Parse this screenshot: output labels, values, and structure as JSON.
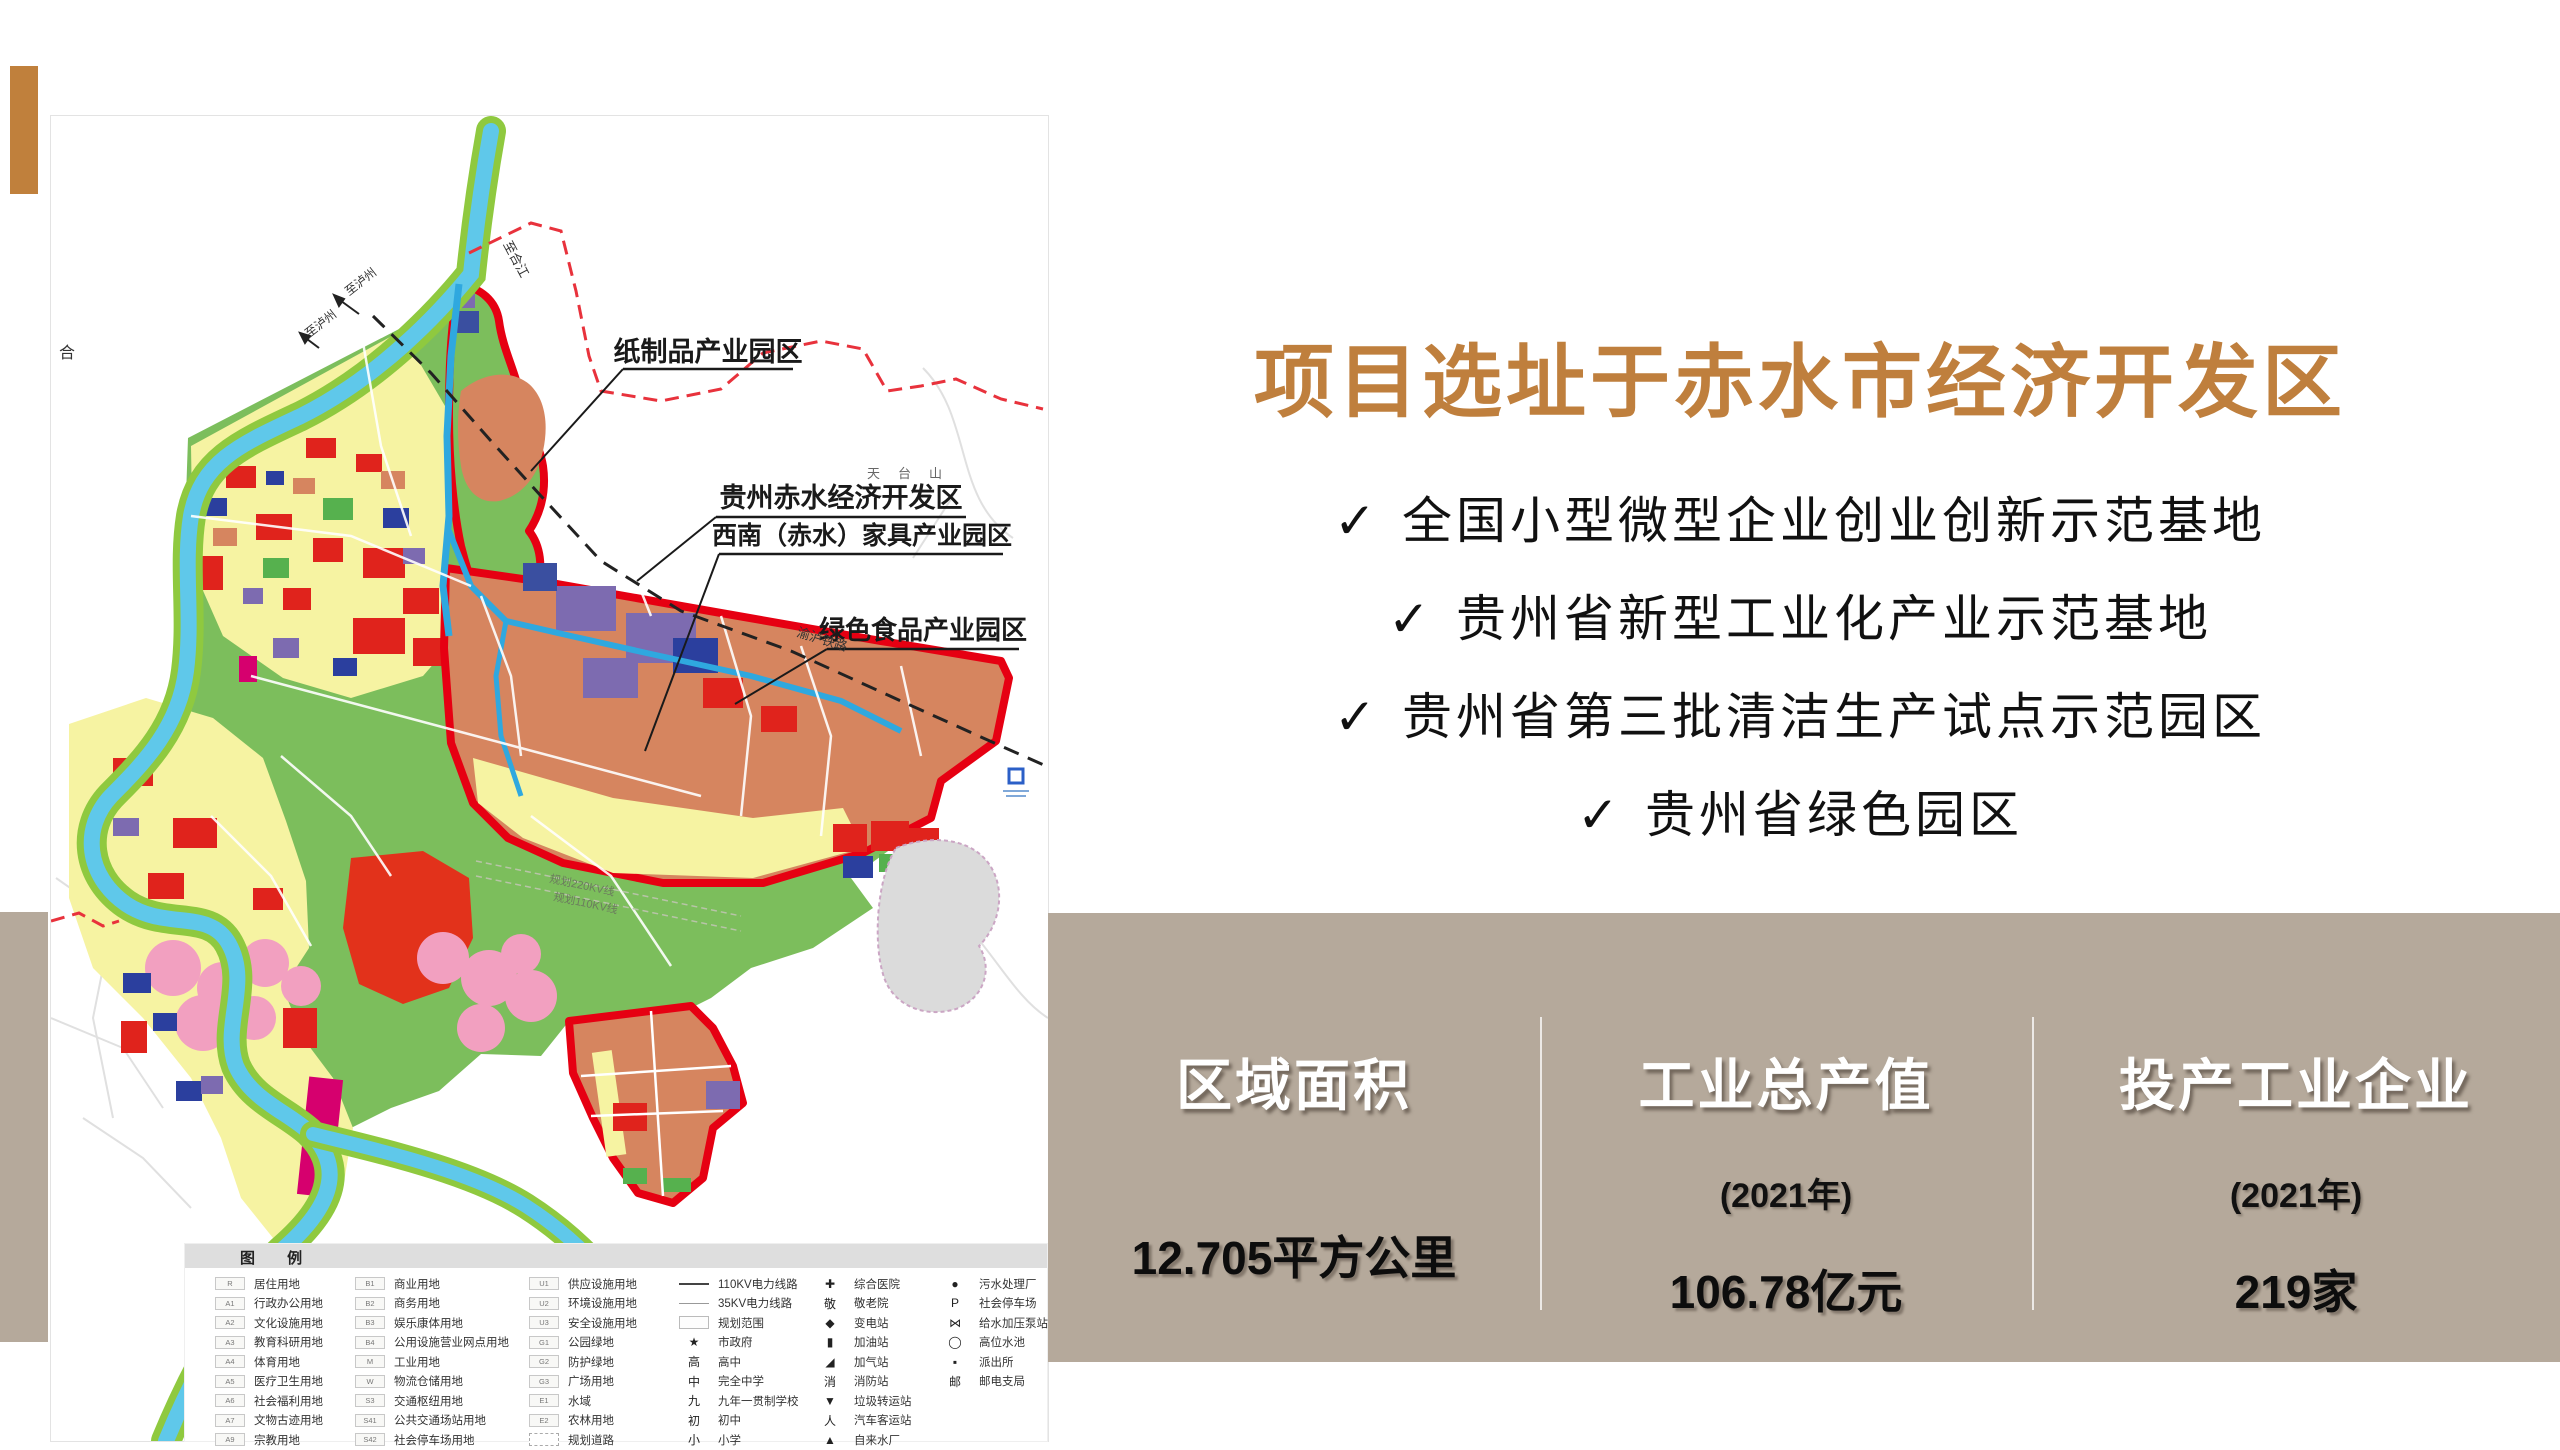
{
  "header": {
    "title": "项目建设地点"
  },
  "right_panel": {
    "headline": "项目选址于赤水市经济开发区",
    "check_glyph": "✓",
    "bullets": [
      "全国小型微型企业创业创新示范基地",
      "贵州省新型工业化产业示范基地",
      "贵州省第三批清洁生产试点示范园区",
      "贵州省绿色园区"
    ]
  },
  "stats_band": {
    "columns": [
      {
        "title": "区域面积",
        "subtitle": "",
        "value": "12.705平方公里"
      },
      {
        "title": "工业总产值",
        "subtitle": "(2021年)",
        "value": "106.78亿元"
      },
      {
        "title": "投产工业企业",
        "subtitle": "(2021年)",
        "value": "219家"
      }
    ]
  },
  "colors": {
    "accent_orange": "#C0803C",
    "headline_orange": "#BF7F3D",
    "stats_taupe": "#B5A99B",
    "map_green": "#7CBE5C",
    "map_yellow": "#F6F3A2",
    "map_salmon": "#D6855F",
    "zone_border_red": "#E60012",
    "river_blue": "#5FC8EA"
  },
  "map": {
    "labels": [
      {
        "t": "纸制品产业园区",
        "x": 657,
        "y": 245,
        "s": 27,
        "w": 700,
        "a": "middle",
        "f": "#1A1A1A"
      },
      {
        "t": "贵州赤水经济开发区",
        "x": 790,
        "y": 391,
        "s": 27,
        "w": 700,
        "a": "middle",
        "f": "#1A1A1A"
      },
      {
        "t": "西南（赤水）家具产业园区",
        "x": 811,
        "y": 428,
        "s": 25,
        "w": 700,
        "a": "middle",
        "f": "#1A1A1A"
      },
      {
        "t": "绿色食品产业园区",
        "x": 872,
        "y": 523,
        "s": 26,
        "w": 700,
        "a": "middle",
        "f": "#1A1A1A"
      },
      {
        "t": "渝泸铁路",
        "x": 745,
        "y": 520,
        "s": 13,
        "r": 17,
        "f": "#333333"
      },
      {
        "t": "至合江",
        "x": 452,
        "y": 128,
        "s": 13,
        "r": 62,
        "f": "#333333"
      },
      {
        "t": "至泸州",
        "x": 298,
        "y": 180,
        "s": 12,
        "r": -38,
        "f": "#333333"
      },
      {
        "t": "至泸州",
        "x": 258,
        "y": 222,
        "s": 12,
        "r": -38,
        "f": "#333333"
      },
      {
        "t": "合",
        "x": 8,
        "y": 242,
        "s": 16,
        "f": "#333333"
      },
      {
        "t": "天台山",
        "x": 816,
        "y": 362,
        "s": 13,
        "f": "#666666",
        "ls": 18
      },
      {
        "t": "规划220KV线",
        "x": 498,
        "y": 766,
        "s": 11,
        "r": 12,
        "f": "#6B7B5E"
      },
      {
        "t": "规划110KV线",
        "x": 502,
        "y": 784,
        "s": 11,
        "r": 12,
        "f": "#6B7B5E"
      },
      {
        "t": "赤水河",
        "x": 598,
        "y": 1185,
        "s": 12,
        "r": 55,
        "f": "#445566"
      }
    ],
    "legend": {
      "title": "图 例",
      "columns": [
        [
          {
            "c": "R",
            "l": "居住用地"
          },
          {
            "c": "A1",
            "l": "行政办公用地"
          },
          {
            "c": "A2",
            "l": "文化设施用地"
          },
          {
            "c": "A3",
            "l": "教育科研用地"
          },
          {
            "c": "A4",
            "l": "体育用地"
          },
          {
            "c": "A5",
            "l": "医疗卫生用地"
          },
          {
            "c": "A6",
            "l": "社会福利用地"
          },
          {
            "c": "A7",
            "l": "文物古迹用地"
          },
          {
            "c": "A9",
            "l": "宗教用地"
          }
        ],
        [
          {
            "c": "B1",
            "l": "商业用地"
          },
          {
            "c": "B2",
            "l": "商务用地"
          },
          {
            "c": "B3",
            "l": "娱乐康体用地"
          },
          {
            "c": "B4",
            "l": "公用设施营业网点用地"
          },
          {
            "c": "M",
            "l": "工业用地"
          },
          {
            "c": "W",
            "l": "物流仓储用地"
          },
          {
            "c": "S3",
            "l": "交通枢纽用地"
          },
          {
            "c": "S41",
            "l": "公共交通场站用地"
          },
          {
            "c": "S42",
            "l": "社会停车场用地"
          }
        ],
        [
          {
            "c": "U1",
            "l": "供应设施用地"
          },
          {
            "c": "U2",
            "l": "环境设施用地"
          },
          {
            "c": "U3",
            "l": "安全设施用地"
          },
          {
            "c": "G1",
            "l": "公园绿地"
          },
          {
            "c": "G2",
            "l": "防护绿地"
          },
          {
            "c": "G3",
            "l": "广场用地"
          },
          {
            "c": "E1",
            "l": "水域"
          },
          {
            "c": "E2",
            "l": "农林用地"
          },
          {
            "c": "",
            "l": "规划道路",
            "t": "road"
          }
        ],
        [
          {
            "s": "",
            "l": "110KV电力线路",
            "t": "line110"
          },
          {
            "s": "",
            "l": "35KV电力线路",
            "t": "line35"
          },
          {
            "s": "",
            "l": "规划范围",
            "t": "range"
          },
          {
            "s": "★",
            "l": "市政府",
            "t": "sym"
          },
          {
            "s": "高",
            "l": "高中",
            "t": "sym"
          },
          {
            "s": "中",
            "l": "完全中学",
            "t": "sym"
          },
          {
            "s": "九",
            "l": "九年一贯制学校",
            "t": "sym"
          },
          {
            "s": "初",
            "l": "初中",
            "t": "sym"
          },
          {
            "s": "小",
            "l": "小学",
            "t": "sym"
          }
        ],
        [
          {
            "s": "✚",
            "l": "综合医院",
            "t": "sym"
          },
          {
            "s": "敬",
            "l": "敬老院",
            "t": "sym"
          },
          {
            "s": "◆",
            "l": "变电站",
            "t": "sym"
          },
          {
            "s": "▮",
            "l": "加油站",
            "t": "sym"
          },
          {
            "s": "◢",
            "l": "加气站",
            "t": "sym"
          },
          {
            "s": "消",
            "l": "消防站",
            "t": "sym"
          },
          {
            "s": "▼",
            "l": "垃圾转运站",
            "t": "sym"
          },
          {
            "s": "人",
            "l": "汽车客运站",
            "t": "sym"
          },
          {
            "s": "▲",
            "l": "自来水厂",
            "t": "sym"
          }
        ],
        [
          {
            "s": "●",
            "l": "污水处理厂",
            "t": "sym"
          },
          {
            "s": "P",
            "l": "社会停车场",
            "t": "sym"
          },
          {
            "s": "⋈",
            "l": "给水加压泵站",
            "t": "sym"
          },
          {
            "s": "◯",
            "l": "高位水池",
            "t": "sym"
          },
          {
            "s": "▪",
            "l": "派出所",
            "t": "sym"
          },
          {
            "s": "邮",
            "l": "邮电支局",
            "t": "sym"
          }
        ]
      ],
      "column_x": [
        30,
        170,
        344,
        494,
        630,
        755
      ]
    }
  }
}
